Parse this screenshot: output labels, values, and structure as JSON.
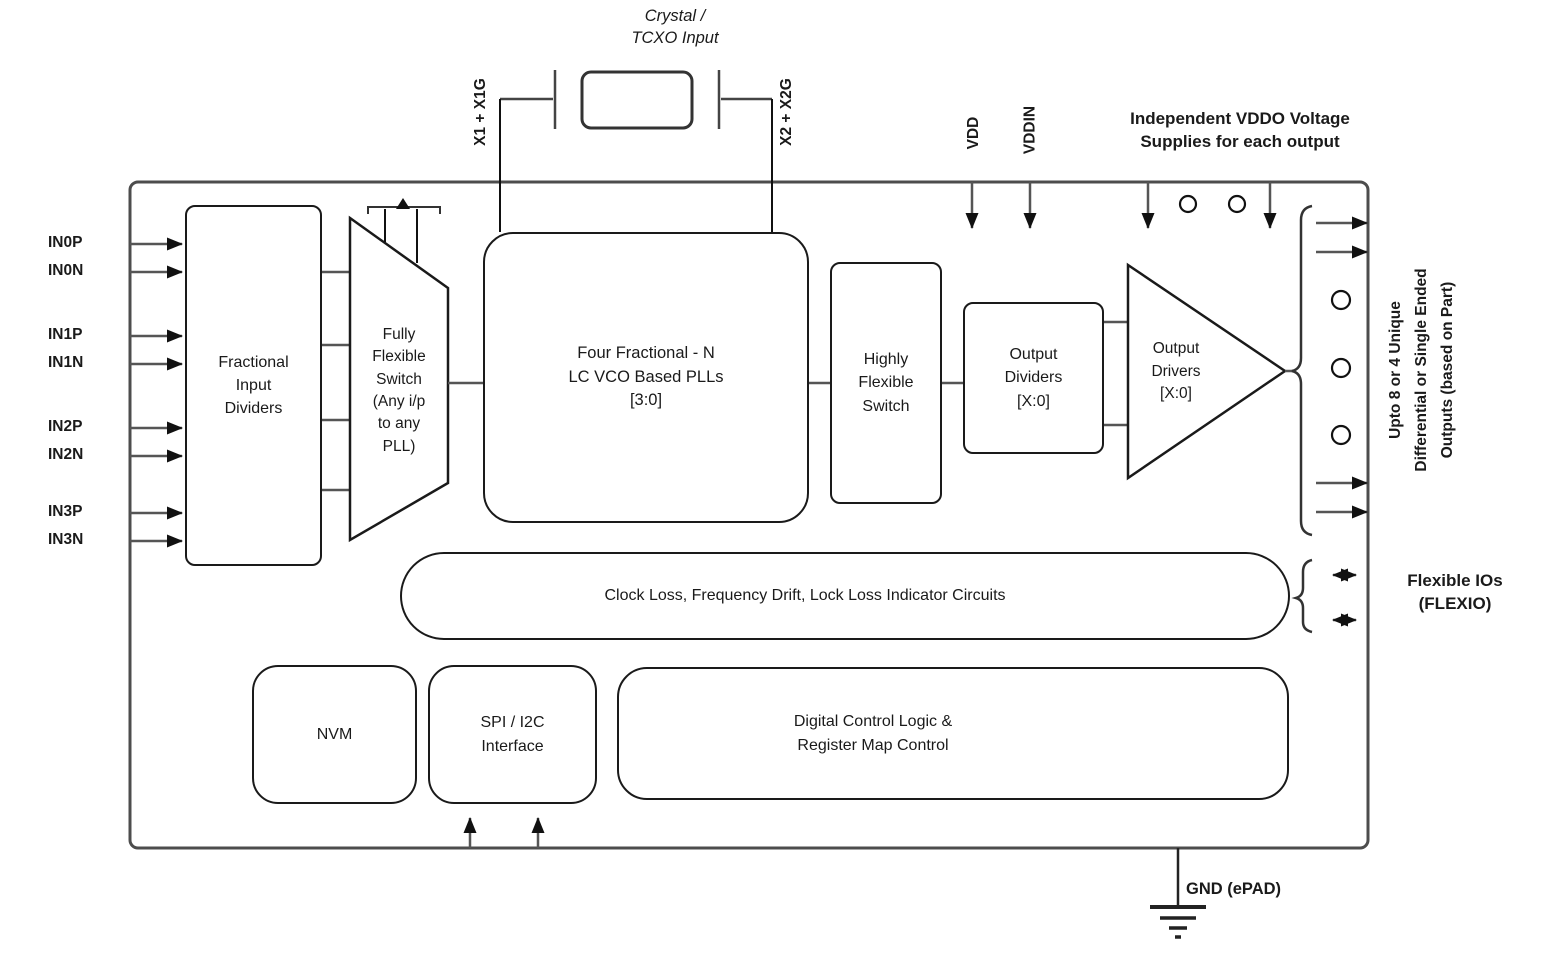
{
  "diagram": {
    "crystal_label": "Crystal /\nTCXO Input",
    "x1_label": "X1 + X1G",
    "x2_label": "X2 + X2G",
    "vdd_label": "VDD",
    "vddin_label": "VDDIN",
    "vddo_note": "Independent VDDO Voltage\nSupplies for each output",
    "inputs": [
      "IN0P",
      "IN0N",
      "IN1P",
      "IN1N",
      "IN2P",
      "IN2N",
      "IN3P",
      "IN3N"
    ],
    "blocks": {
      "fractional_input_dividers": "Fractional\nInput\nDividers",
      "fully_flexible_switch": "Fully\nFlexible\nSwitch\n(Any i/p\nto any\nPLL)",
      "plls": "Four Fractional - N\nLC VCO Based PLLs\n[3:0]",
      "highly_flexible_switch": "Highly\nFlexible\nSwitch",
      "output_dividers": "Output\nDividers\n[X:0]",
      "output_drivers": "Output\nDrivers\n[X:0]",
      "clock_loss": "Clock Loss, Frequency Drift, Lock Loss Indicator Circuits",
      "nvm": "NVM",
      "spi_interface": "SPI / I2C\nInterface",
      "digital_control": "Digital Control Logic &\nRegister Map Control"
    },
    "right_outputs_note": "Upto 8 or 4 Unique\nDifferential or Single Ended\nOutputs (based on Part)",
    "flexio_label": "Flexible IOs\n(FLEXIO)",
    "gnd_label": "GND (ePAD)",
    "colors": {
      "line": "#555555",
      "block_border": "#1a1a1a",
      "text": "#1a1a1a",
      "background": "#ffffff"
    }
  }
}
